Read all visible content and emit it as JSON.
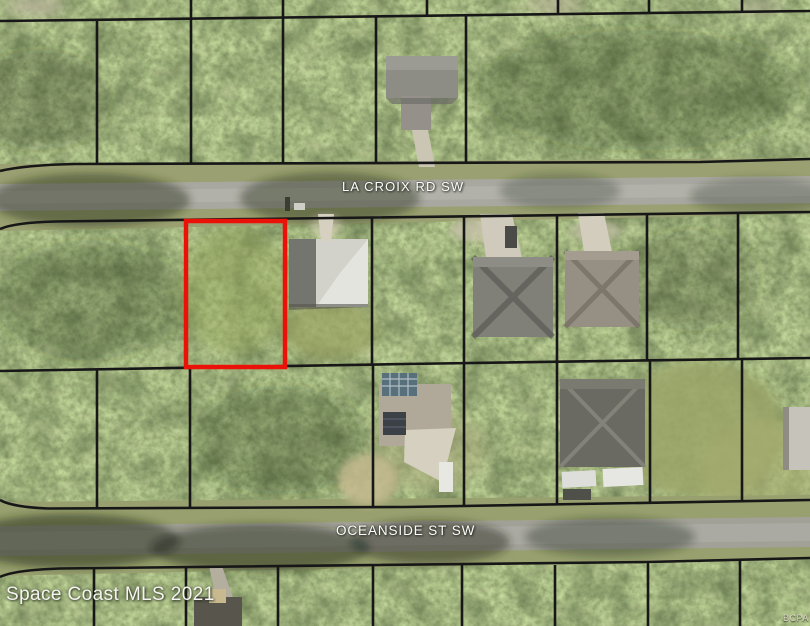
{
  "map": {
    "kind": "aerial-parcel-map",
    "watermark": "Space Coast MLS 2021",
    "corner_attribution": "BCPA",
    "roads": [
      {
        "label": "LA CROIX RD SW"
      },
      {
        "label": "OCEANSIDE ST SW"
      }
    ],
    "highlight": {
      "color": "#ea1208",
      "x": 186,
      "y": 221,
      "width": 99,
      "height": 146
    },
    "boundary_line_color": "#171717",
    "label_color": "#fdfdfd"
  }
}
